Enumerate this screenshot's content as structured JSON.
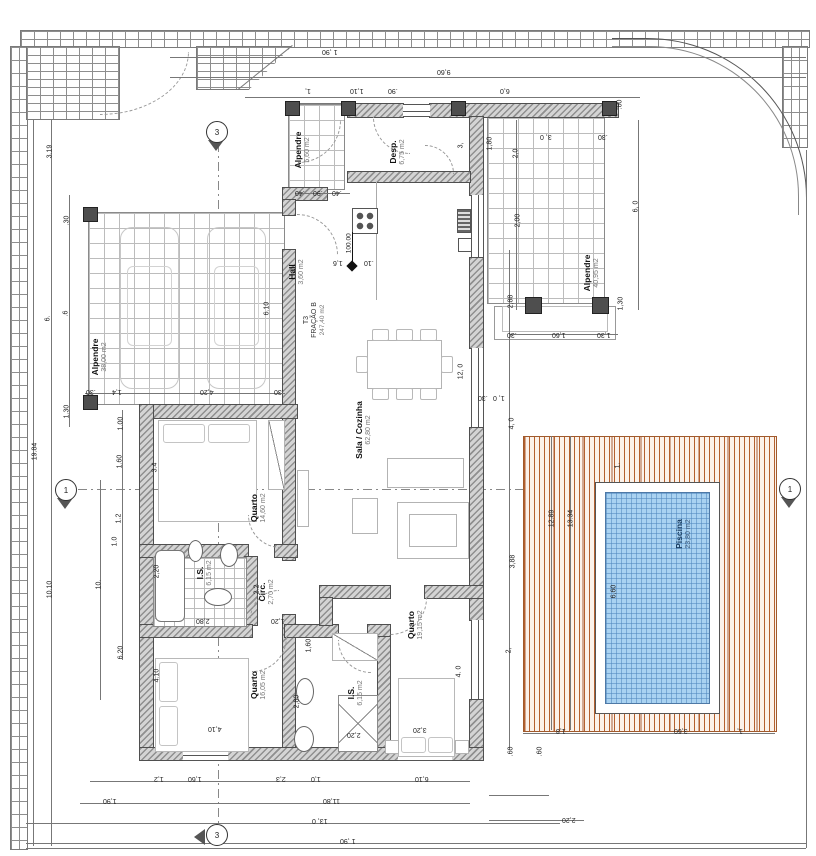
{
  "unit": {
    "type": "T3",
    "fraction": "FRAÇÃO B",
    "total_area": "247,40 m2"
  },
  "rooms": {
    "garage": {
      "name": "Alpendre",
      "area": "38,00 m2"
    },
    "porch_small": {
      "name": "Alpendre",
      "area": "5,60 m2"
    },
    "pantry": {
      "name": "Desp.",
      "area": "6,75 m2"
    },
    "hall": {
      "name": "Hall",
      "area": "3,60 m2"
    },
    "living": {
      "name": "Sala / Cozinha",
      "area": "62,80 m2"
    },
    "porch_right": {
      "name": "Alpendre",
      "area": "40,95 m2"
    },
    "bedroom1": {
      "name": "Quarto",
      "area": "14,60 m2"
    },
    "bath1": {
      "name": "I.S.",
      "area": "6,15 m2"
    },
    "circ": {
      "name": "Circ.",
      "area": "2,70 m2"
    },
    "bedroom2": {
      "name": "Quarto",
      "area": "16,05 m2"
    },
    "bath2": {
      "name": "I.S.",
      "area": "6,15 m2"
    },
    "bedroom3": {
      "name": "Quarto",
      "area": "19,15 m2"
    },
    "pool": {
      "name": "Piscina",
      "area": "23,80 m2"
    }
  },
  "level_marker": "100.00",
  "section_markers": {
    "top": "3",
    "bottom": "3",
    "left": "1",
    "right": "1"
  },
  "colors": {
    "pool_water": "#a9d2f1",
    "deck_stripe": "#b4602d",
    "wall_fill": "#8f8f8f"
  },
  "dims": {
    "t1": "1 ,90",
    "t2": "9,60",
    "t3a": "1,",
    "t3b": "1,10",
    "t3c": ".90",
    "t3d": "6,0",
    "rt1": ".60",
    "rt2": "6, 0",
    "rt3": "1,30",
    "rt4": ".30",
    "rt5": "1,60",
    "rt6": "1,30",
    "rt7": ".30",
    "rc1": "2,0",
    "rc2": "2,00",
    "rc3": "2,88",
    "rc4": "1, 0",
    "rc5": "4, 0",
    "rc6": "3,88",
    "rc7": "2,",
    "dk1": "12.89",
    "dk2": "13.34",
    "dk3": "1.",
    "dk4": "6,60",
    "dk5": "1,8",
    "dk6": "3,60",
    "dk7": "1,",
    "dk8": ".60",
    "dk9": ".60",
    "dk10": "2,20",
    "lf1": "19.84",
    "lf2": "3.19",
    "lf3": "6.",
    "lf4": "10.10",
    "lf5": ".30",
    "lf6": ".6",
    "lf7": "1.30",
    "lf8": "1.00",
    "lf9": "1.60",
    "lf10": "1.2",
    "lf11": "1.0",
    "lf12": "10.",
    "lf13": "6.20",
    "g1": "4,20",
    "g2": "1,4",
    "g3": ".30",
    "g4": ".30",
    "g5": "6.10",
    "k1": ".40",
    "k2": ".90",
    "k3": ".40",
    "h1": "1,6",
    "h2": ".10",
    "p1": "3,",
    "p2": "1,80",
    "a1": "3, 0",
    "a2": ".30",
    "s1": "12, 0",
    "q1": "3.4",
    "q2": "2,20",
    "q3": "2.2",
    "q5": "2,80",
    "q6": "1,20",
    "q7": "4.10",
    "q8": "4,10",
    "q10": "1,60",
    "q11": "2,20",
    "q12": "2,80",
    "q13": "3,20",
    "q14": "4. 0",
    "b1": "1,2",
    "b2": "1,60",
    "b3": "2,3",
    "b4": "1,0",
    "b5": "6,10",
    "b6": "1,90",
    "b7": "11,80",
    "b8": "13, 0",
    "b9": "1 ,90"
  }
}
